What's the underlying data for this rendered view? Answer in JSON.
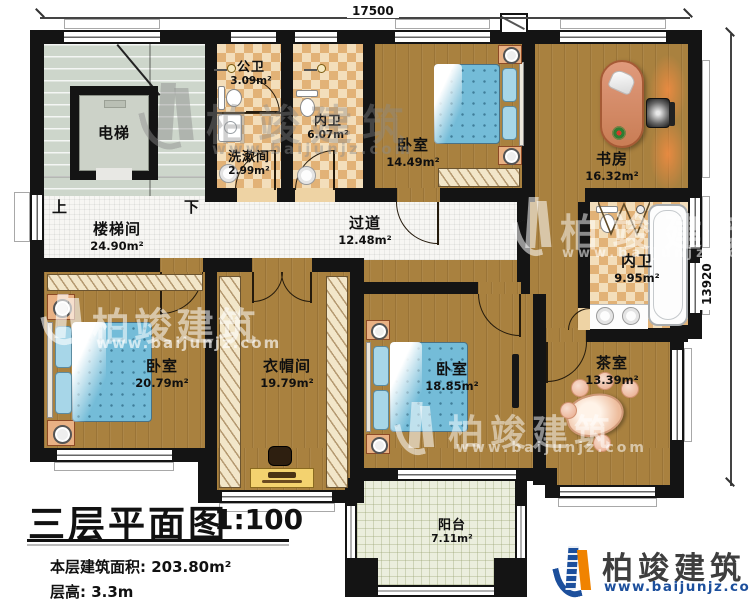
{
  "dimensions": {
    "top": "17500",
    "right": "13920"
  },
  "rooms": {
    "stairwell": {
      "name": "楼梯间",
      "area": "24.90m²"
    },
    "elevator": {
      "name": "电梯"
    },
    "stairs_up": "上",
    "stairs_down": "下",
    "public_bath": {
      "name": "公卫",
      "area": "3.09m²"
    },
    "washroom": {
      "name": "洗漱间",
      "area": "2.99m²"
    },
    "inner_bath_small": {
      "name": "内卫",
      "area": "6.07m²"
    },
    "bedroom_top": {
      "name": "卧室",
      "area": "14.49m²"
    },
    "study": {
      "name": "书房",
      "area": "16.32m²"
    },
    "corridor": {
      "name": "过道",
      "area": "12.48m²"
    },
    "inner_bath_large": {
      "name": "内卫",
      "area": "9.95m²"
    },
    "bedroom_left": {
      "name": "卧室",
      "area": "20.79m²"
    },
    "cloakroom": {
      "name": "衣帽间",
      "area": "19.79m²"
    },
    "bedroom_middle": {
      "name": "卧室",
      "area": "18.85m²"
    },
    "tea_room": {
      "name": "茶室",
      "area": "13.39m²"
    },
    "balcony": {
      "name": "阳台",
      "area": "7.11m²"
    }
  },
  "title_block": {
    "title": "三层平面图",
    "scale": "1:100",
    "area_line": "本层建筑面积: 203.80m²",
    "floor_height_line": "层高: 3.3m"
  },
  "brand": {
    "name": "柏竣建筑",
    "website": "www.baijunjz.com"
  },
  "watermark": {
    "name": "柏竣建筑",
    "website": "www.baijunjz.com"
  },
  "colors": {
    "wall": "#141414",
    "wood": "#a9813f",
    "tile_light": "#f3debb",
    "tile_dark": "#e2b277",
    "stair": "#cdd6cb",
    "corridor_tile": "#f7f6f3",
    "balcony": "#ebeedd",
    "bed_blue": "#74bcd8",
    "brand_blue": "#1c4f9c",
    "brand_orange": "#f08300"
  }
}
